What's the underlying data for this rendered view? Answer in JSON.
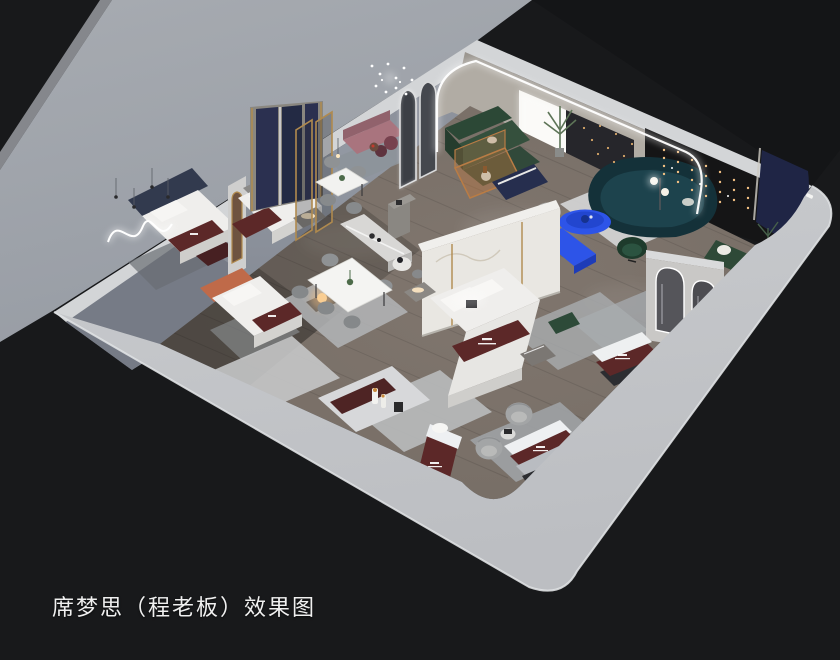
{
  "caption": "席梦思（程老板）效果图",
  "alt": "3D isometric cutaway rendering of a mattress showroom with bedroom, dining and lounge displays",
  "palette": {
    "bg": "#18191b",
    "apron": "#a7abb1",
    "apron_deep": "#979ca4",
    "wall_top": "#d3d5d7",
    "wall_bright": "#c9cbce",
    "wall_bright2": "#bcbec2",
    "wall_inner": "#8e939d",
    "wall_warm": "#9b968f",
    "arch_inner": "#b1aca4",
    "dark_wall": "#151516",
    "drape": "#26262b",
    "navy_panel": "#1f2545",
    "navy_partition": "#2b3050",
    "floor_main": "#756c64",
    "floor_dark": "#544e49",
    "rug_light": "#d4d5d6",
    "rug_gray": "#a2a6a9",
    "marble": "#e9e7e2",
    "gold": "#b08a4e",
    "white_soft": "#efeeec",
    "maroon": "#5c2828",
    "silver": "#b9bcc1",
    "green_sofa": "#35503d",
    "green_dark": "#2c4836",
    "teal": "#143139",
    "blue": "#2d54e8",
    "mauve": "#a9747e",
    "plum": "#77414e",
    "orange": "#bf6a49",
    "chair_gray": "#8f9294",
    "barrel": "#a3a5a6",
    "wood_amber": "#b97c45",
    "plant": "#5d7457",
    "warm_light": "#f2c083",
    "led": "#ffffff",
    "caption_color": "#f0f0f0"
  }
}
